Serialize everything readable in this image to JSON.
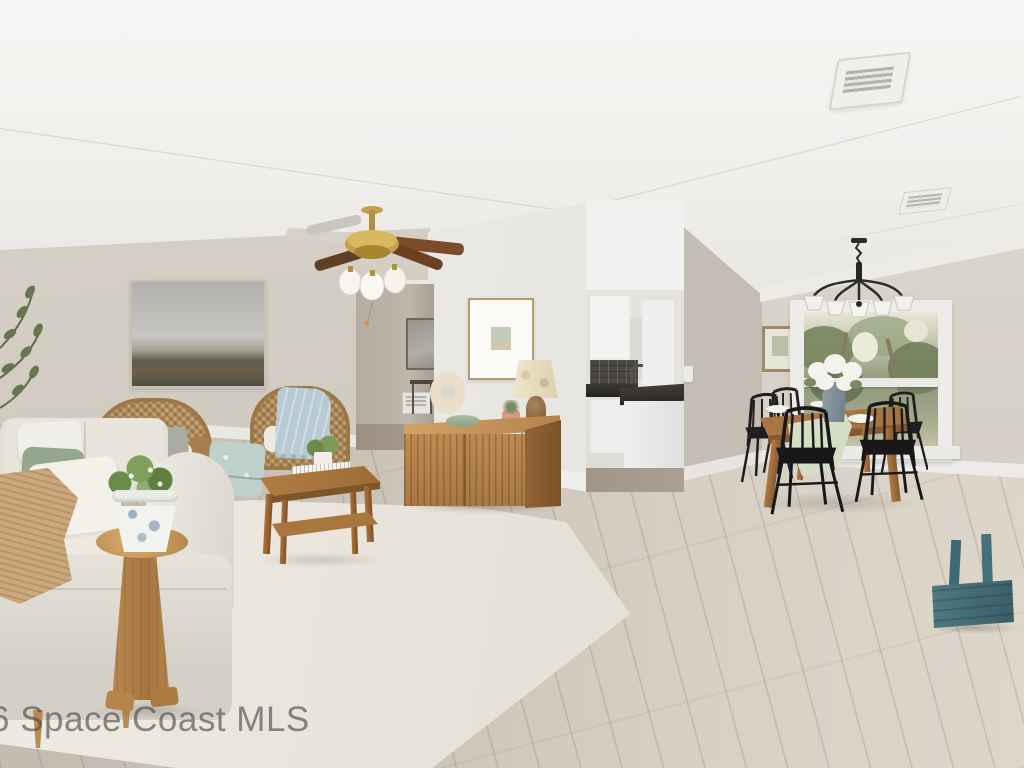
{
  "meta": {
    "type": "real-estate-listing-photo",
    "description": "Staged open-plan living room with dining area and kitchen glimpse, light wood-look flooring, greige walls"
  },
  "watermark": {
    "text": "6 Space Coast MLS"
  },
  "palette": {
    "ceiling": "#f3f2ef",
    "wall_left": "#d5cfc5",
    "wall_white": "#edebe7",
    "wall_dining": "#d6d0c7",
    "hallway": "#b7afa4",
    "floor_light": "#d8d1c6",
    "floor_dark": "#c3bab0",
    "rug": "#eae6de",
    "wood": "#b5824d",
    "wood_dark": "#8a5f34",
    "sofa": "#e6e2da",
    "wicker": "#ab875a",
    "sage_pillow": "#93a68f",
    "blue_throw": "#b3c5ce",
    "tan_throw": "#c9a87c",
    "chair_black": "#242424",
    "brass": "#c3a04c",
    "teal_caddy": "#4a737c",
    "counter_black": "#35322e"
  },
  "objects": [
    "ceiling-fan",
    "ceiling-vent",
    "chandelier",
    "window-with-trees",
    "landscape-art",
    "matted-art",
    "hallway-art",
    "botanical-art",
    "sofa-with-pillows",
    "wicker-armchair",
    "wicker-armchair-blue-throw",
    "gray-pouf",
    "patterned-ottoman",
    "coffee-table",
    "carved-stool",
    "chinoiserie-planter",
    "credenza",
    "table-lamp",
    "donut-vase",
    "dining-table",
    "black-spindle-chairs",
    "hydrangea-vase",
    "kitchen-cabinets",
    "teal-caddy",
    "area-rug",
    "left-plant"
  ]
}
